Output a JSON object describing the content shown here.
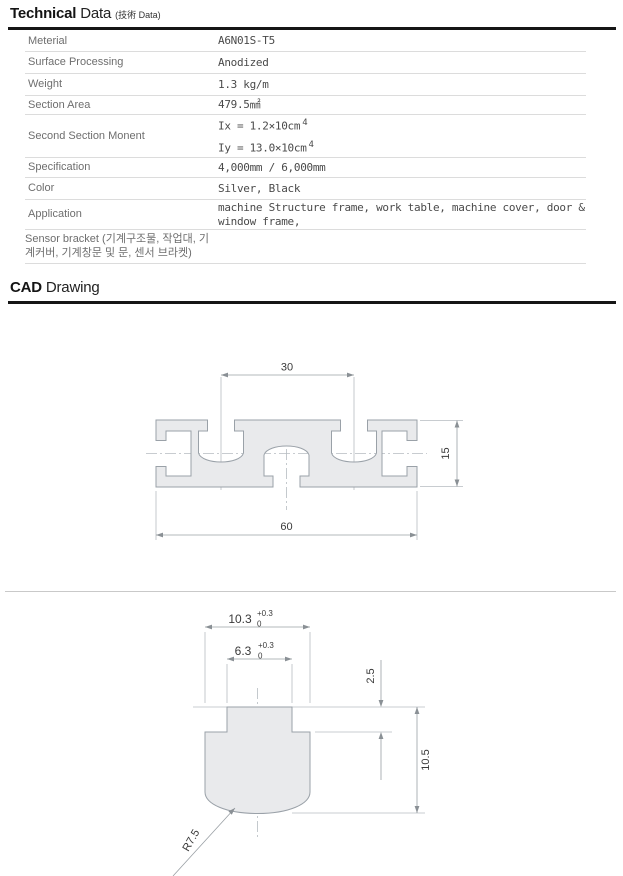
{
  "tech_header": {
    "title_bold": "Technical",
    "title_rest": " Data",
    "subtitle": "(技術 Data)"
  },
  "cad_header": {
    "title_bold": "CAD",
    "title_rest": " Drawing"
  },
  "table": {
    "rows": [
      {
        "label": "Meterial",
        "value": "A6N01S-T5"
      },
      {
        "label": "Surface Processing",
        "value": "Anodized"
      },
      {
        "label": "Weight",
        "value": "1.3 kg/m"
      },
      {
        "label": "Section Area",
        "value": "479.5㎟"
      },
      {
        "label": "Second Section Monent",
        "moment_line1": "Ix = 1.2×10cm",
        "moment_sup1": "4",
        "moment_line2": "Iy = 13.0×10cm",
        "moment_sup2": "4"
      },
      {
        "label": "Specification",
        "value": "4,000mm / 6,000mm"
      },
      {
        "label": "Color",
        "value": "Silver, Black"
      },
      {
        "label": "Application",
        "value_line1": "machine Structure frame, work table, machine cover, door &",
        "value_line2": "window frame,"
      },
      {
        "label_line1": "Sensor bracket (기계구조물, 작업대, 기",
        "label_line2": "계커버, 기계창문 및 문, 센서 브라켓)"
      }
    ]
  },
  "drawing1": {
    "dim_top_width": "30",
    "dim_bottom_width": "60",
    "dim_height": "15"
  },
  "drawing2": {
    "dim_outer": "10.3",
    "dim_outer_tol_upper": "+0.3",
    "dim_outer_tol_lower": "0",
    "dim_inner": "6.3",
    "dim_inner_tol_upper": "+0.3",
    "dim_inner_tol_lower": "0",
    "dim_lip_depth": "2.5",
    "dim_total_depth": "10.5",
    "dim_radius": "R7.5"
  },
  "colors": {
    "heading_rule": "#161616",
    "table_rule": "#dcdcdc",
    "profile_fill": "#e9eaec",
    "profile_stroke": "#9aa1a8",
    "dim_line": "#9aa0a5",
    "dim_text": "#3a3a3a"
  }
}
